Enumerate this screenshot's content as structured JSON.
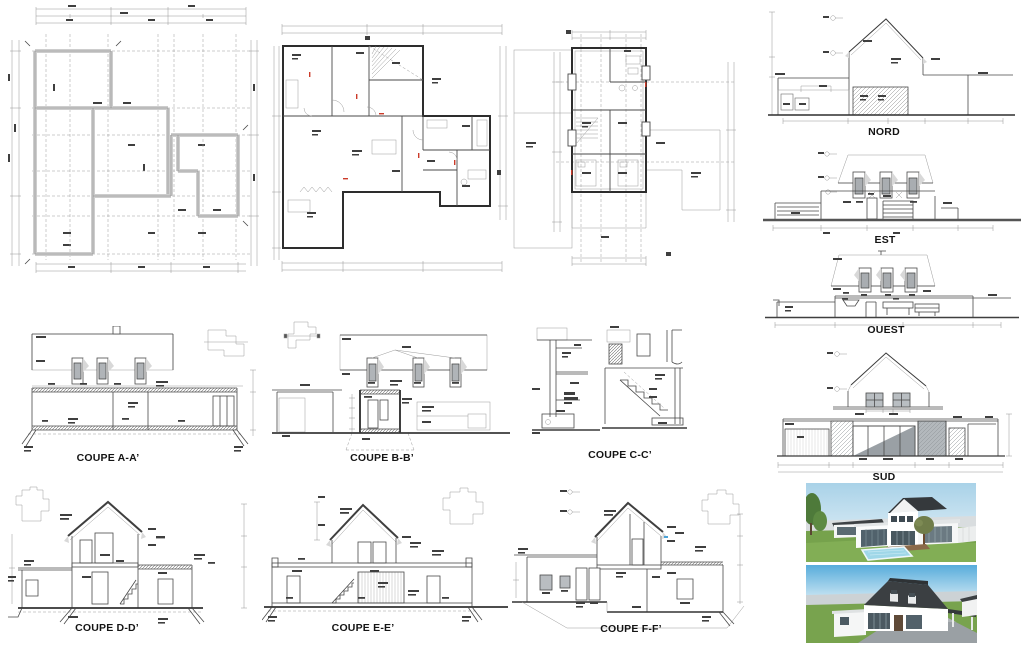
{
  "plans": {
    "foundation": {
      "name": "foundation-plan"
    },
    "ground_floor": {
      "name": "ground-floor-plan"
    },
    "upper_floor": {
      "name": "upper-floor-plan"
    }
  },
  "elevations": [
    {
      "id": "nord",
      "label": "NORD"
    },
    {
      "id": "est",
      "label": "EST"
    },
    {
      "id": "ouest",
      "label": "OUEST"
    },
    {
      "id": "sud",
      "label": "SUD"
    }
  ],
  "sections": [
    {
      "id": "aa",
      "label": "COUPE A-A’"
    },
    {
      "id": "bb",
      "label": "COUPE B-B’"
    },
    {
      "id": "cc",
      "label": "COUPE C-C’"
    },
    {
      "id": "dd",
      "label": "COUPE D-D’"
    },
    {
      "id": "ee",
      "label": "COUPE E-E’"
    },
    {
      "id": "ff",
      "label": "COUPE F-F’"
    }
  ],
  "renders": [
    {
      "name": "exterior-3d-render-garden-pool"
    },
    {
      "name": "exterior-3d-render-entrance-drive"
    }
  ],
  "colors": {
    "paper": "#ffffff",
    "line_dark": "#3a3a3a",
    "line_light": "#9b9b9b",
    "wall_fill": "#d8d8d8",
    "hatch_gray": "#8c8c8c",
    "accent_red": "#cc3b2a",
    "sky_blue": "#56aede",
    "grass_green": "#76a24c",
    "roof_dark": "#3b3f42",
    "pool_blue": "#9fd7e8",
    "paving_gray": "#9aa0a4"
  }
}
